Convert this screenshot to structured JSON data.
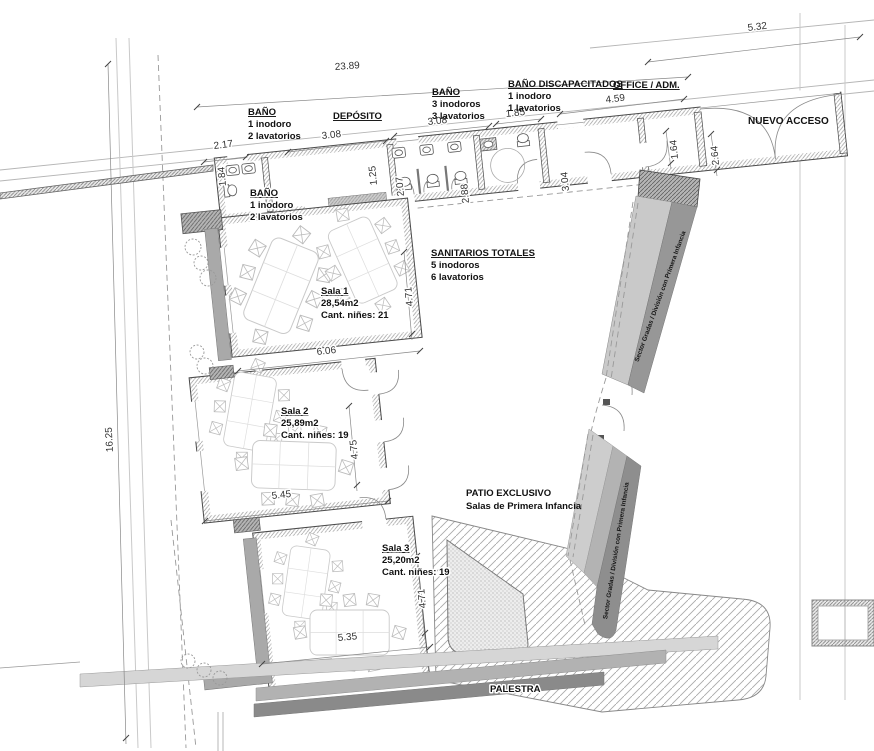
{
  "plan": {
    "labels": {
      "bano_top": {
        "title": "BAÑO",
        "line1": "1 inodoro",
        "line2": "2 lavatorios"
      },
      "deposito": {
        "title": "DEPÓSITO"
      },
      "bano_main": {
        "title": "BAÑO",
        "line1": "3 inodoros",
        "line2": "3 lavatorios"
      },
      "bano_disc": {
        "title": "BAÑO DISCAPACITADOS",
        "line1": "1 inodoro",
        "line2": "1 lavatorios"
      },
      "office": {
        "title": "OFFICE / ADM."
      },
      "acceso": {
        "title": "NUEVO ACCESO"
      },
      "bano_inner": {
        "title": "BAÑO",
        "line1": "1 inodoro",
        "line2": "2 lavatorios"
      },
      "sanitarios": {
        "title": "SANITARIOS TOTALES",
        "line1": "5 inodoros",
        "line2": "6 lavatorios"
      },
      "patio": {
        "line1": "PATIO EXCLUSIVO",
        "line2": "Salas de Primera Infancia"
      },
      "palestra": {
        "title": "PALESTRA"
      },
      "gradas1": {
        "title": "Sector Gradas / División con Primera Infancia"
      },
      "gradas2": {
        "title": "Sector Gradas / División con Primera Infancia"
      }
    },
    "salas": {
      "sala1": {
        "title": "Sala  1",
        "area": "28,54m2",
        "capacity": "Cant. niñes: 21"
      },
      "sala2": {
        "title": "Sala  2",
        "area": "25,89m2",
        "capacity": "Cant. niñes: 19"
      },
      "sala3": {
        "title": "Sala  3",
        "area": "25,20m2",
        "capacity": "Cant. niñes: 19"
      }
    },
    "dimensions": {
      "total_top": "23.89",
      "access_front": "5.32",
      "bano_top_w": "2.17",
      "deposito_w": "3.08",
      "bano_main_w": "3.08",
      "bano_disc_w": "1.85",
      "office_w": "4.59",
      "bano_top_d": "1.84",
      "strip_d1": "1.25",
      "bano_main_d1": "2.07",
      "bano_main_d2": "2.88",
      "office_d": "3.04",
      "vest_w": "1.64",
      "access_d": "2.64",
      "sala1_d": "4.71",
      "sala1_w": "6.06",
      "sala2_d": "4.75",
      "sala2_w": "5.45",
      "sala3_d": "4.71",
      "sala3_w": "5.35",
      "site_left": "16.25"
    },
    "colors": {
      "band_light": "#c9c9c9",
      "band_mid": "#b3b3b3",
      "band_dark": "#979797",
      "exterior_band": "#a9a9a9",
      "line": "#4a4a4a"
    }
  }
}
